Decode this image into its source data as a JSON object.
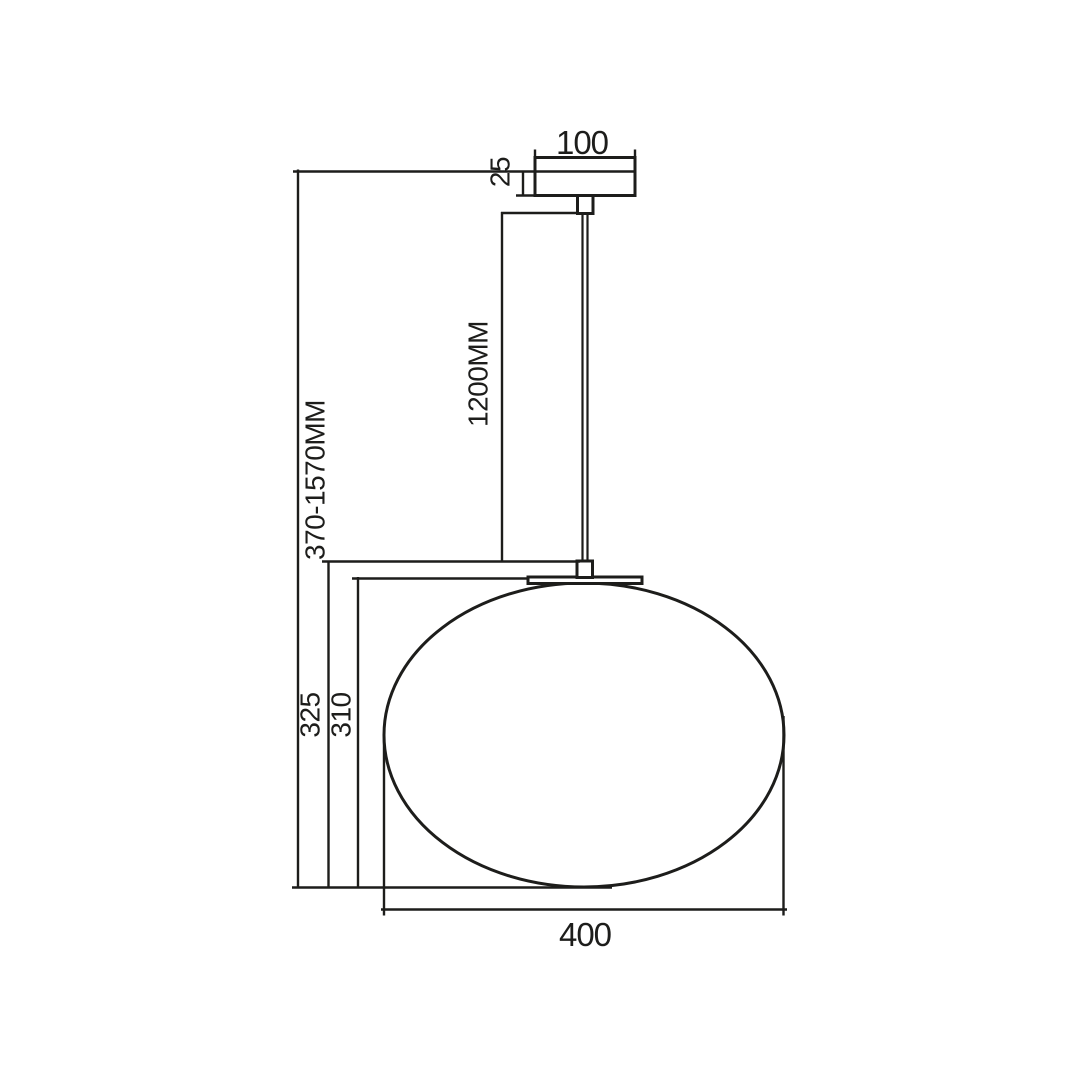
{
  "colors": {
    "background": "#ffffff",
    "line": "#1d1d1b"
  },
  "drawing": {
    "type": "technical-dimension-drawing",
    "subject": "globe pendant ceiling lamp",
    "labels": {
      "canopy_width": "100",
      "canopy_height": "25",
      "rod_length": "1200MM",
      "overall_height_range": "370-1570MM",
      "fixture_drop": "325",
      "shade_height": "310",
      "shade_width": "400"
    }
  }
}
